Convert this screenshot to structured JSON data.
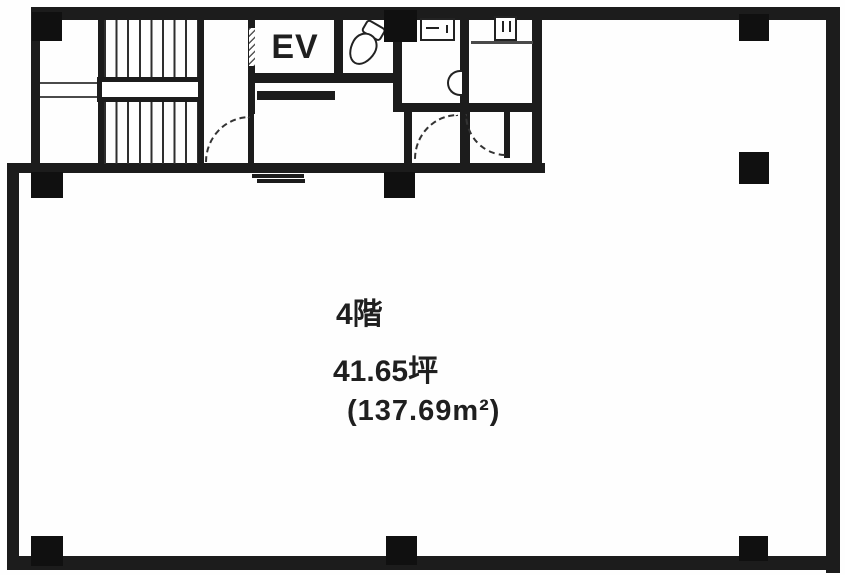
{
  "plan": {
    "elevator_label": "EV",
    "floor_label": "4階",
    "area_tsubo": "41.65坪",
    "area_sqm": "(137.69m²)"
  },
  "elements": {
    "rooms": [
      "staircase",
      "stair-hall",
      "elevator",
      "toilet",
      "lavatory",
      "washroom",
      "elevator-hall",
      "vestibule-left",
      "vestibule-right",
      "main-open-floor"
    ],
    "fixtures": [
      "tilted-toilet-bowl",
      "toilet-with-tank",
      "washbasin"
    ],
    "structural_columns": 9,
    "door_swings": 3
  },
  "colors": {
    "wall": "#1c1c1c",
    "background": "#ffffff",
    "text": "#1f1f1f"
  }
}
